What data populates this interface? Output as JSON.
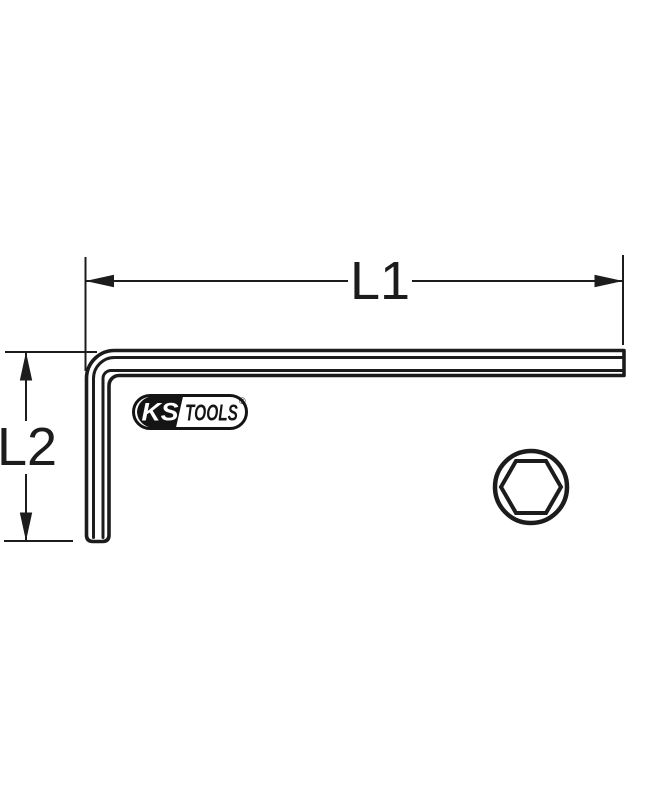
{
  "page": {
    "background": "#ffffff",
    "line_color": "#1c1c1c"
  },
  "diagram": {
    "type": "technical-dimension-drawing",
    "subject": "hex-allen-key",
    "l1": {
      "label": "L1"
    },
    "l2": {
      "label": "L2"
    },
    "logo": {
      "ks": "KS",
      "tools": "TOOLS",
      "mark": "®",
      "panel_color": "#141414",
      "text_color": "#ffffff"
    },
    "cross_section": {
      "icon": "hex-socket-icon",
      "shape": "hexagon-in-circle"
    }
  }
}
